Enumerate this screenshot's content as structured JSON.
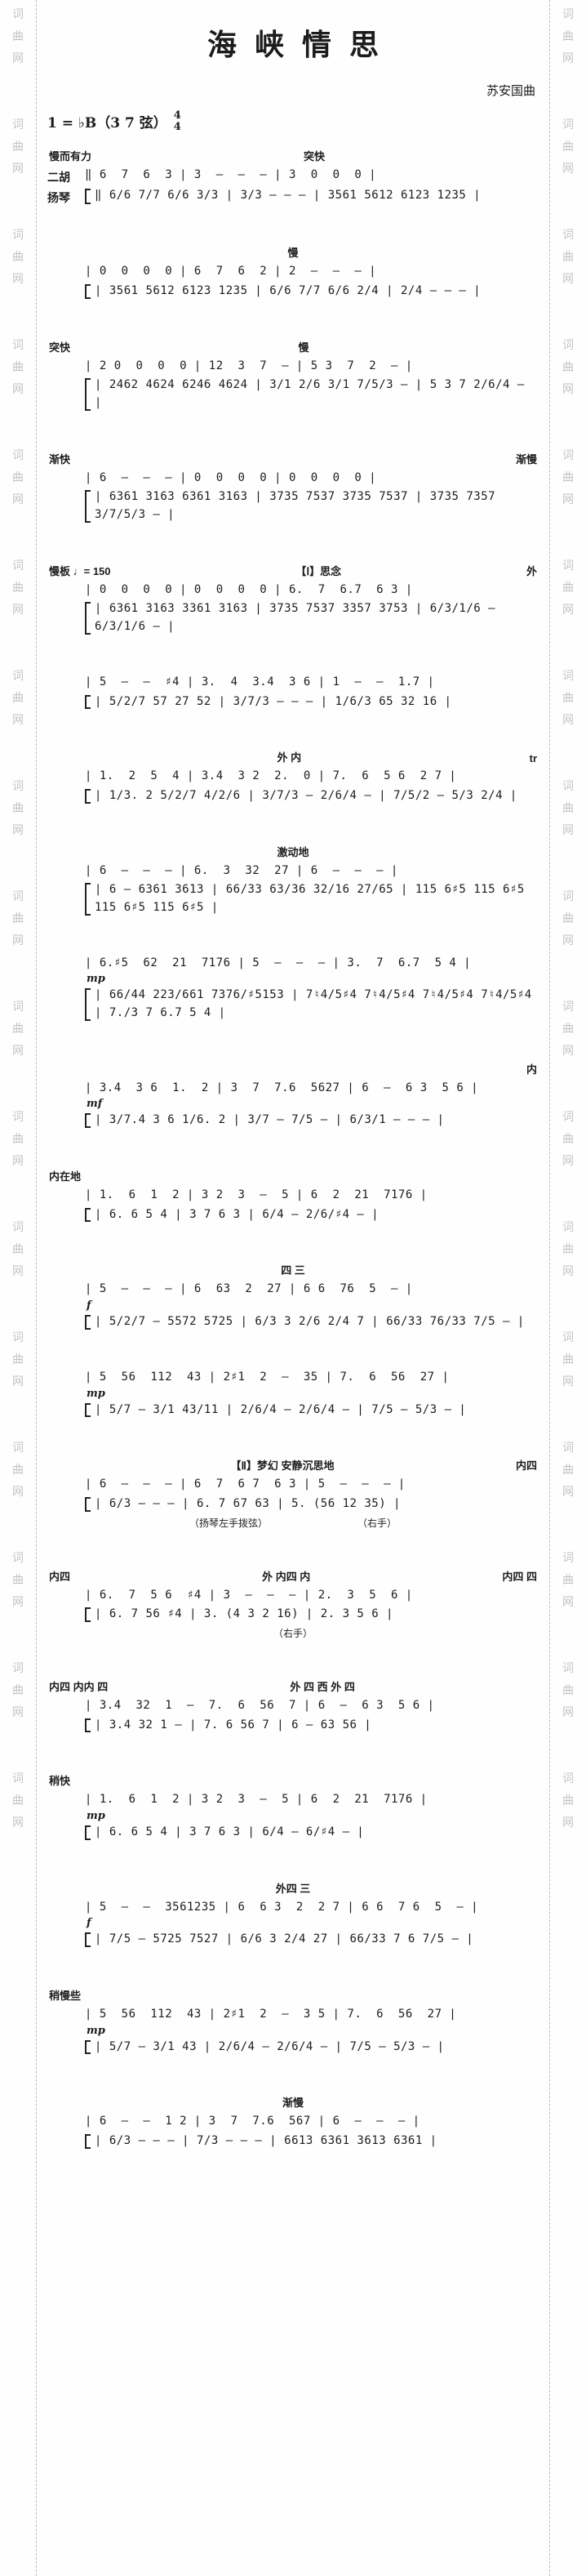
{
  "watermark": {
    "text": "词曲网",
    "repeat": 17,
    "color": "#c3c3c3"
  },
  "header": {
    "title": "海峡情思",
    "composer": "苏安国曲",
    "key": "1 = ♭B（3 7 弦）",
    "meter_top": "4",
    "meter_bottom": "4"
  },
  "part_labels": {
    "erhu": "二胡",
    "yangqin": "扬琴"
  },
  "systems": [
    {
      "ann_left": "慢而有力",
      "ann_mid": "突快",
      "ann_right": "",
      "erhu_label": "二胡",
      "yangqin_label": "扬琴",
      "erhu": "‖ 6  7  6  3 ∣ 3  –  –  – ∣ 3  0  0  0 ∣",
      "yangqin": [
        "‖ 6/6 7/7 6/6 3/3 ∣ 3/3 – – – ∣ 3561 5612 6123 1235 ∣"
      ]
    },
    {
      "ann_left": "",
      "ann_mid": "慢",
      "ann_right": "",
      "erhu": "∣ 0  0  0  0 ∣ 6  7  6  2 ∣ 2  –  –  – ∣",
      "yangqin": [
        "∣ 3561 5612 6123 1235 ∣ 6/6 7/7 6/6 2/4 ∣ 2/4 – – – ∣"
      ]
    },
    {
      "ann_left": "突快",
      "ann_mid": "慢",
      "ann_right": "",
      "erhu": "∣ 2 0  0  0  0 ∣ 12  3  7  – ∣ 5 3  7  2  – ∣",
      "yangqin": [
        "∣ 2462 4624 6246 4624 ∣ 3/1 2/6 3/1 7/5/3 – ∣ 5 3 7 2/6/4 – ∣"
      ]
    },
    {
      "ann_left": "渐快",
      "ann_mid": "",
      "ann_right": "渐慢",
      "erhu": "∣ 6  –  –  – ∣ 0  0  0  0 ∣ 0  0  0  0 ∣",
      "yangqin": [
        "∣ 6361 3163 6361 3163 ∣ 3735 7537 3735 7537 ∣ 3735 7357 3/7/5/3 – ∣"
      ]
    },
    {
      "ann_left": "慢板 ♩= 150",
      "ann_mid": "【Ⅰ】思念",
      "ann_right": "外",
      "erhu": "∣ 0  0  0  0 ∣ 0  0  0  0 ∣ 6.  7  6.7  6 3 ∣",
      "yangqin": [
        "∣ 6361 3163 3361 3163 ∣ 3735 7537 3357 3753 ∣ 6/3/1/6 – 6/3/1/6 – ∣"
      ]
    },
    {
      "ann_left": "",
      "ann_mid": "",
      "ann_right": "",
      "erhu": "∣ 5  –  –  ♯4 ∣ 3.  4  3.4  3 6 ∣ 1  –  –  1.7 ∣",
      "yangqin": [
        "∣ 5/2/7 57 27 52 ∣ 3/7/3 – – – ∣ 1/6/3 65 32 16 ∣"
      ]
    },
    {
      "ann_left": "",
      "ann_mid": "外  内",
      "ann_right": "tr",
      "erhu": "∣ 1.  2  5  4 ∣ 3.4  3 2  2.  0 ∣ 7.  6  5 6  2 7 ∣",
      "yangqin": [
        "∣ 1/3. 2 5/2/7 4/2/6 ∣ 3/7/3 – 2/6/4 – ∣ 7/5/2 – 5/3 2/4 ∣"
      ]
    },
    {
      "ann_left": "",
      "ann_mid": "激动地",
      "ann_right": "",
      "erhu": "∣ 6  –  –  – ∣ 6.  3  32  27 ∣ 6  –  –  – ∣",
      "yangqin": [
        "∣ 6 – 6361 3613 ∣ 66/33 63/36 32/16 27/65 ∣ 115 6♯5 115 6♯5 115 6♯5 115 6♯5 ∣"
      ]
    },
    {
      "ann_left": "",
      "ann_mid": "",
      "ann_right": "",
      "dyn": "mp",
      "erhu": "∣ 6.♯5  62  21  7176 ∣ 5  –  –  – ∣ 3.  7  6.7  5 4 ∣",
      "yangqin": [
        "∣ 66/44 223/661 7376/♯5153 ∣ 7♮4/5♯4 7♮4/5♯4 7♮4/5♯4 7♮4/5♯4 ∣ 7./3 7 6.7 5 4 ∣"
      ]
    },
    {
      "ann_left": "",
      "ann_mid": "",
      "ann_right": "内",
      "dyn": "mf",
      "erhu": "∣ 3.4  3 6  1.  2 ∣ 3  7  7.6  5627 ∣ 6  –  6 3  5 6 ∣",
      "yangqin": [
        "∣ 3/7.4 3 6 1/6. 2 ∣ 3/7 – 7/5 – ∣ 6/3/1 – – – ∣"
      ]
    },
    {
      "ann_left": "内在地",
      "ann_mid": "",
      "ann_right": "",
      "erhu": "∣ 1.  6  1  2 ∣ 3 2  3  –  5 ∣ 6  2  21  7176 ∣",
      "yangqin": [
        "∣ 6. 6 5 4 ∣ 3 7 6 3 ∣ 6/4 – 2/6/♯4 – ∣"
      ]
    },
    {
      "ann_left": "",
      "ann_mid": "四  三",
      "ann_right": "",
      "dyn": "f",
      "erhu": "∣ 5  –  –  – ∣ 6  63  2  27 ∣ 6 6  76  5  – ∣",
      "yangqin": [
        "∣ 5/2/7 – 5572 5725 ∣ 6/3 3 2/6 2/4 7 ∣ 66/33 76/33 7/5 – ∣"
      ]
    },
    {
      "ann_left": "",
      "ann_mid": "",
      "ann_right": "",
      "dyn": "mp",
      "erhu": "∣ 5  56  112  43 ∣ 2♯1  2  –  35 ∣ 7.  6  56  27 ∣",
      "yangqin": [
        "∣ 5/7 – 3/1 43/11 ∣ 2/6/4 – 2/6/4 – ∣ 7/5 – 5/3 – ∣"
      ]
    },
    {
      "ann_left": "",
      "ann_mid": "【Ⅱ】梦幻  安静沉思地",
      "ann_right": "内四",
      "sub_left": "（扬琴左手拨弦）",
      "sub_right": "（右手）",
      "erhu": "∣ 6  –  –  – ∣ 6  7  6 7  6 3 ∣ 5  –  –  – ∣",
      "yangqin": [
        "∣ 6/3 – – – ∣ 6. 7 67 63 ∣ 5. (56 12 35) ∣"
      ]
    },
    {
      "ann_left": "内四",
      "ann_mid": "外  内四  内",
      "ann_right": "内四  四",
      "sub_left": "（右手）",
      "sub_right": "",
      "erhu": "∣ 6.  7  5 6  ♯4 ∣ 3  –  –  – ∣ 2.  3  5  6 ∣",
      "yangqin": [
        "∣ 6. 7 56 ♯4 ∣ 3. (4 3 2 16) ∣ 2. 3 5 6 ∣"
      ]
    },
    {
      "ann_left": "内四 内内 四",
      "ann_mid": "外  四  西  外  四",
      "ann_right": "",
      "erhu": "∣ 3.4  32  1  –  7.  6  56  7 ∣ 6  –  6 3  5 6 ∣",
      "yangqin": [
        "∣ 3.4 32 1 – ∣ 7. 6 56 7 ∣ 6 – 63 56 ∣"
      ]
    },
    {
      "ann_left": "稍快",
      "ann_mid": "",
      "ann_right": "",
      "dyn": "mp",
      "erhu": "∣ 1.  6  1  2 ∣ 3 2  3  –  5 ∣ 6  2  21  7176 ∣",
      "yangqin": [
        "∣ 6. 6 5 4 ∣ 3 7 6 3 ∣ 6/4 – 6/♯4 – ∣"
      ]
    },
    {
      "ann_left": "",
      "ann_mid": "外四  三",
      "ann_right": "",
      "dyn": "f",
      "erhu": "∣ 5  –  –  3561235 ∣ 6  6 3  2  2 7 ∣ 6 6  7 6  5  – ∣",
      "yangqin": [
        "∣ 7/5 – 5725 7527 ∣ 6/6 3 2/4 27 ∣ 66/33 7 6 7/5 – ∣"
      ]
    },
    {
      "ann_left": "稍慢些",
      "ann_mid": "",
      "ann_right": "",
      "dyn": "mp",
      "erhu": "∣ 5  56  112  43 ∣ 2♯1  2  –  3 5 ∣ 7.  6  56  27 ∣",
      "yangqin": [
        "∣ 5/7 – 3/1 43 ∣ 2/6/4 – 2/6/4 – ∣ 7/5 – 5/3 – ∣"
      ]
    },
    {
      "ann_left": "",
      "ann_mid": "渐慢",
      "ann_right": "",
      "erhu": "∣ 6  –  –  1 2 ∣ 3  7  7.6  567 ∣ 6  –  –  – ∣",
      "yangqin": [
        "∣ 6/3 – – – ∣ 7/3 – – – ∣ 6613 6361 3613 6361 ∣"
      ]
    }
  ]
}
